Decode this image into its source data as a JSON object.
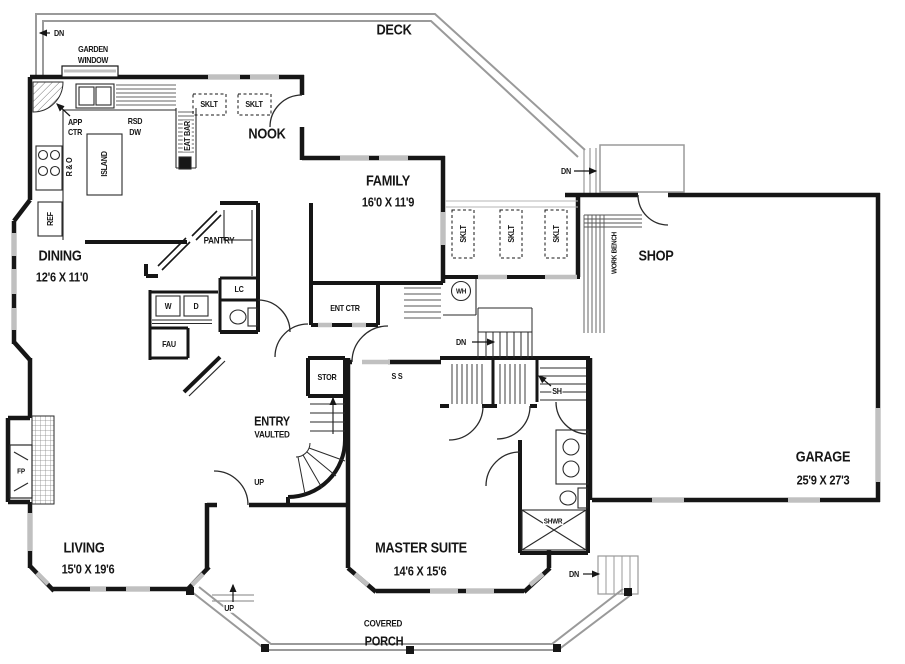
{
  "plan": {
    "type": "floor-plan",
    "wall_color": "#161616",
    "window_color": "#c0c0c0",
    "deck_line_color": "#9a9a9a",
    "background": "#ffffff"
  },
  "rooms": {
    "deck": {
      "name": "DECK"
    },
    "nook": {
      "name": "NOOK"
    },
    "family": {
      "name": "FAMILY",
      "dims": "16'0 X 11'9"
    },
    "dining": {
      "name": "DINING",
      "dims": "12'6 X 11'0"
    },
    "shop": {
      "name": "SHOP"
    },
    "garage": {
      "name": "GARAGE",
      "dims": "25'9 X 27'3"
    },
    "living": {
      "name": "LIVING",
      "dims": "15'0 X 19'6"
    },
    "master_suite": {
      "name": "MASTER SUITE",
      "dims": "14'6 X 15'6"
    },
    "entry": {
      "name": "ENTRY",
      "note": "VAULTED"
    },
    "pantry": {
      "name": "PANTRY"
    },
    "covered_porch": {
      "line1": "COVERED",
      "line2": "PORCH"
    }
  },
  "fixtures": {
    "garden_window": {
      "line1": "GARDEN",
      "line2": "WINDOW"
    },
    "appliance_center": {
      "line1": "APP",
      "line2": "CTR"
    },
    "rsd_dw": {
      "line1": "RSD",
      "line2": "DW"
    },
    "eat_bar": "EAT BAR",
    "island": "ISLAND",
    "range_oven": "R & O",
    "refrigerator": "REF",
    "skylight": "SKLT",
    "water_heater": "WH",
    "work_bench": "WORK BENCH",
    "linen_cabinet": "LC",
    "washer": "W",
    "dryer": "D",
    "furnace": "FAU",
    "entertainment_center": "ENT CTR",
    "storage": "STOR",
    "shelf": "SH",
    "shelves_ss": "S S",
    "fireplace": "FP",
    "shower": "SHWR"
  },
  "stairs": {
    "dn": "DN",
    "up": "UP"
  }
}
